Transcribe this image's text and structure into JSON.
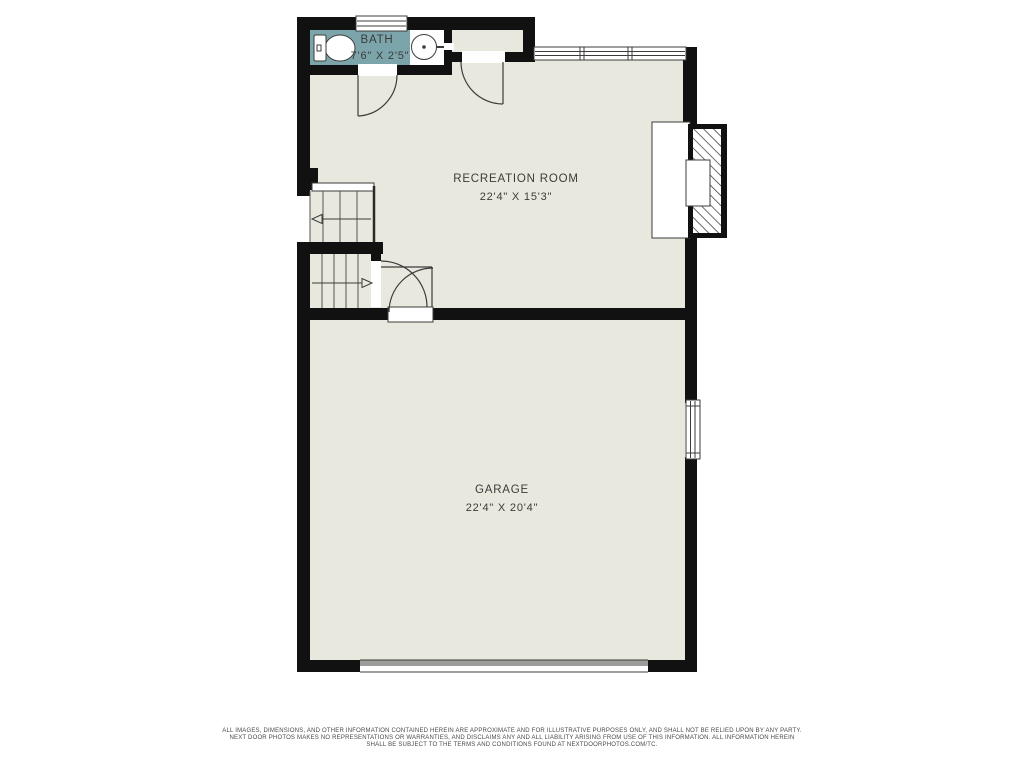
{
  "floorplan": {
    "rooms": [
      {
        "id": "bath",
        "name": "BATH",
        "dimensions": "7'6\" X 2'5\""
      },
      {
        "id": "recreation-room",
        "name": "RECREATION ROOM",
        "dimensions": "22'4\" X 15'3\""
      },
      {
        "id": "garage",
        "name": "GARAGE",
        "dimensions": "22'4\" X 20'4\""
      }
    ],
    "features": {
      "stairs": "two flights with up/down direction arrows",
      "fixtures": [
        "toilet",
        "pedestal-sink"
      ],
      "fireplace": "hatched chimney on right wall of recreation room",
      "windows": [
        "bath-window",
        "recreation-room-window-band",
        "garage-side-window"
      ],
      "doors": [
        "bath-door",
        "closet-door",
        "stair-door",
        "garage-entry-door"
      ],
      "garage_door": "wide overhead door on bottom wall"
    },
    "colors": {
      "wall": "#111111",
      "room_fill": "#e9e8df",
      "bath_fill": "#7ca5ab",
      "fixture_fill": "#ffffff",
      "garage_door_gray": "#9c9c98",
      "text": "#3b3b39"
    }
  },
  "disclaimer": {
    "line1": "ALL IMAGES, DIMENSIONS, AND OTHER INFORMATION CONTAINED HEREIN ARE APPROXIMATE AND FOR ILLUSTRATIVE PURPOSES ONLY, AND SHALL NOT BE RELIED UPON BY ANY PARTY.",
    "line2": "NEXT DOOR PHOTOS MAKES NO REPRESENTATIONS OR WARRANTIES, AND DISCLAIMS ANY AND ALL LIABILITY ARISING FROM USE OF THIS INFORMATION. ALL INFORMATION HEREIN",
    "line3": "SHALL BE SUBJECT TO THE TERMS AND CONDITIONS FOUND AT NEXTDOORPHOTOS.COM/TC."
  }
}
